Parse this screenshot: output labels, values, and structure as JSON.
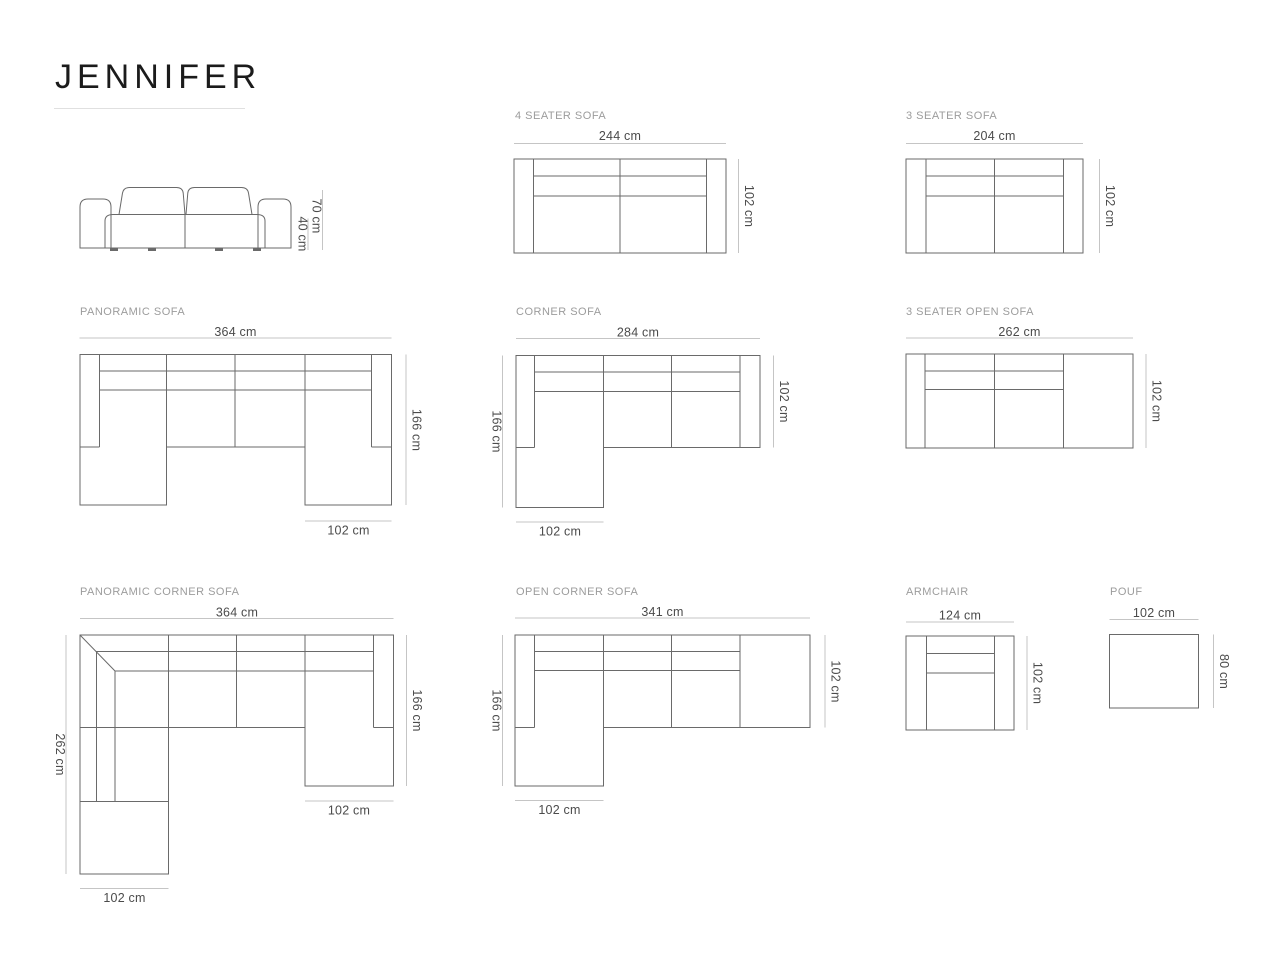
{
  "title": "JENNIFER",
  "colors": {
    "background": "#ffffff",
    "title_text": "#1b1b1b",
    "label_text": "#9c9c9c",
    "dimension_text": "#4b4b4b",
    "outline_stroke": "#6a6a6a",
    "dimension_line": "#c5c5c5",
    "underline": "#e0e0e0"
  },
  "front_view": {
    "total_height": "70 cm",
    "seat_height": "40 cm"
  },
  "models": {
    "four_seater": {
      "label": "4 SEATER SOFA",
      "width": "244 cm",
      "depth": "102 cm"
    },
    "three_seater": {
      "label": "3 SEATER SOFA",
      "width": "204 cm",
      "depth": "102 cm"
    },
    "panoramic": {
      "label": "PANORAMIC SOFA",
      "width": "364 cm",
      "depth": "166 cm",
      "chaise_width": "102 cm"
    },
    "corner": {
      "label": "CORNER SOFA",
      "width": "284 cm",
      "total_depth": "166 cm",
      "depth": "102 cm",
      "chaise_width": "102 cm"
    },
    "three_seater_open": {
      "label": "3 SEATER OPEN SOFA",
      "width": "262 cm",
      "depth": "102 cm"
    },
    "panoramic_corner": {
      "label": "PANORAMIC CORNER SOFA",
      "width": "364 cm",
      "left_depth": "262 cm",
      "right_depth": "166 cm",
      "right_chaise_width": "102 cm",
      "bottom_chaise_width": "102 cm"
    },
    "open_corner": {
      "label": "OPEN CORNER SOFA",
      "width": "341 cm",
      "total_depth": "166 cm",
      "depth": "102 cm",
      "chaise_width": "102 cm"
    },
    "armchair": {
      "label": "ARMCHAIR",
      "width": "124 cm",
      "depth": "102 cm"
    },
    "pouf": {
      "label": "POUF",
      "width": "102 cm",
      "depth": "80 cm"
    }
  }
}
